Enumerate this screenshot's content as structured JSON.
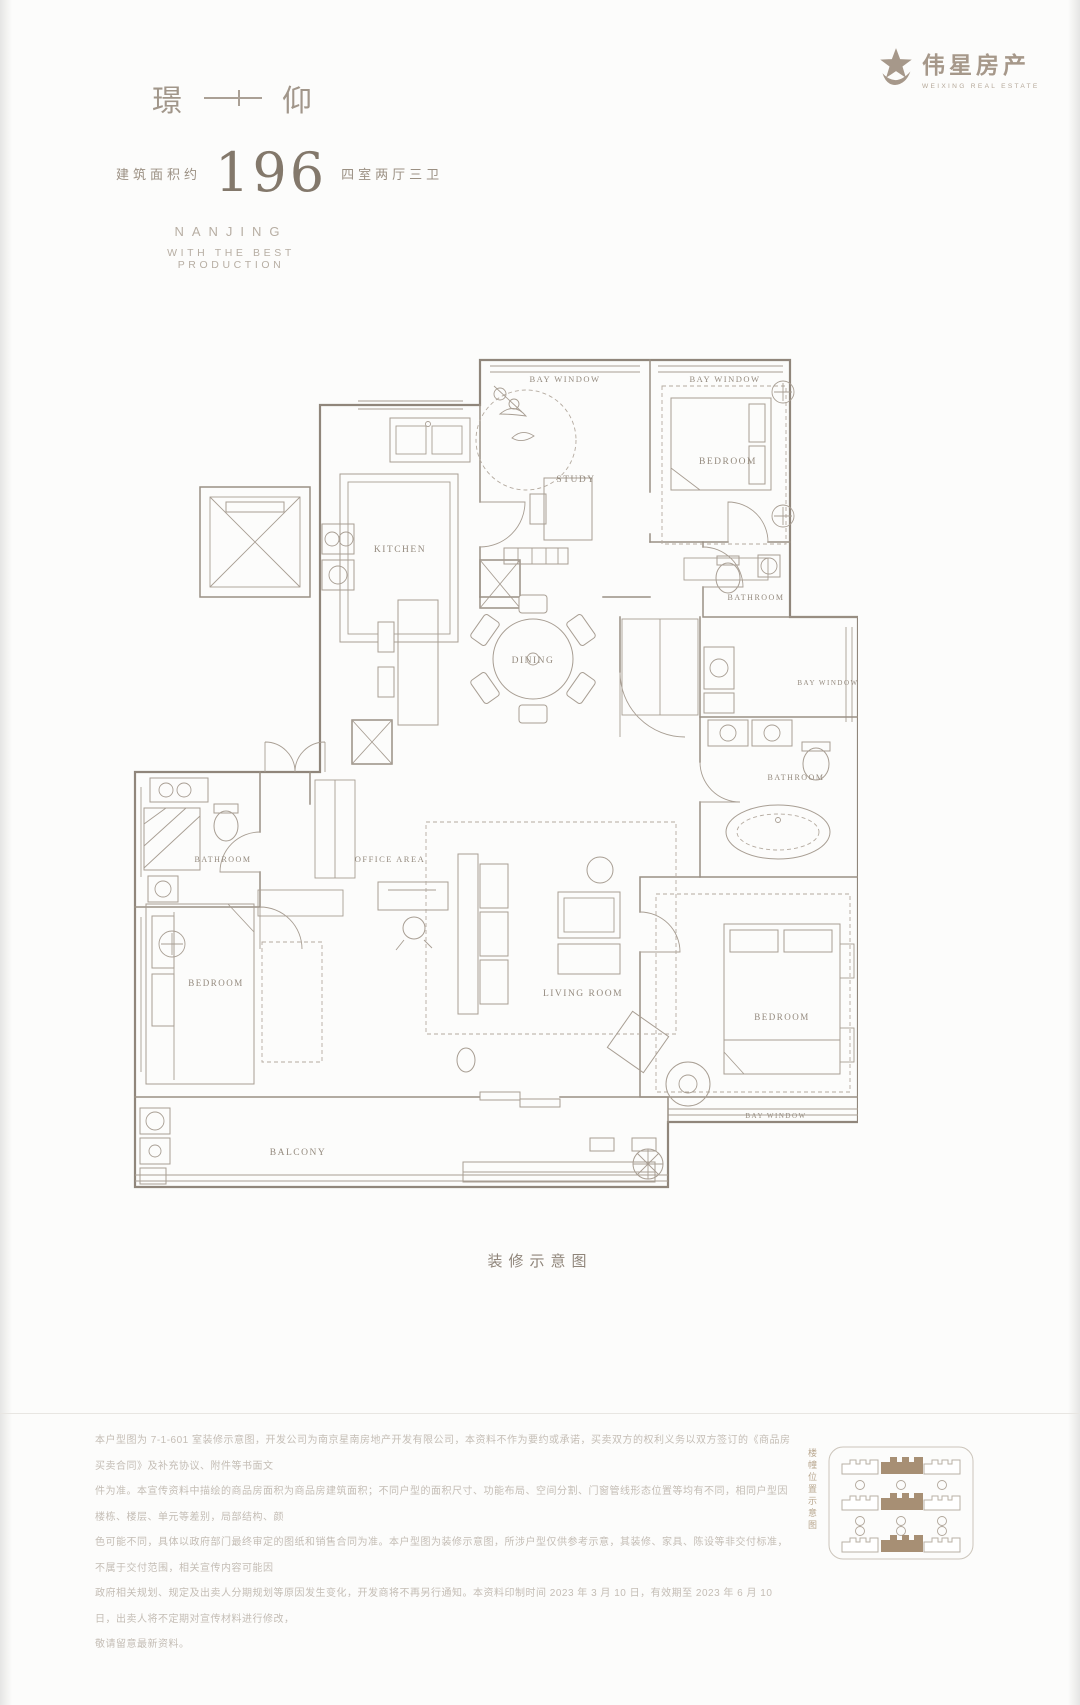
{
  "brand": {
    "logo_cn": "伟星房产",
    "logo_en": "WEIXING REAL ESTATE"
  },
  "header": {
    "title_left": "璟",
    "title_right": "仰",
    "area_label": "建筑面积约",
    "area_value": "196",
    "layout_label": "四室两厅三卫",
    "subtitle_line1": "NANJING",
    "subtitle_line2": "WITH THE BEST PRODUCTION"
  },
  "plan": {
    "caption": "装修示意图",
    "rooms": [
      {
        "label": "BAY WINDOW",
        "x": 437,
        "y": 30,
        "s": 8.5
      },
      {
        "label": "BAY WINDOW",
        "x": 597,
        "y": 30,
        "s": 8.5
      },
      {
        "label": "KITCHEN",
        "x": 272,
        "y": 200,
        "s": 9.5
      },
      {
        "label": "STUDY",
        "x": 448,
        "y": 130,
        "s": 9.5
      },
      {
        "label": "BEDROOM",
        "x": 600,
        "y": 112,
        "s": 9.5
      },
      {
        "label": "BATHROOM",
        "x": 628,
        "y": 248,
        "s": 8
      },
      {
        "label": "BAY WINDOW",
        "x": 700,
        "y": 333,
        "s": 7
      },
      {
        "label": "DINING",
        "x": 405,
        "y": 311,
        "s": 9.5
      },
      {
        "label": "BATHROOM",
        "x": 668,
        "y": 428,
        "s": 8
      },
      {
        "label": "OFFICE AREA",
        "x": 262,
        "y": 510,
        "s": 8.5
      },
      {
        "label": "BATHROOM",
        "x": 95,
        "y": 510,
        "s": 8
      },
      {
        "label": "LIVING ROOM",
        "x": 455,
        "y": 644,
        "s": 9.5
      },
      {
        "label": "BEDROOM",
        "x": 88,
        "y": 634,
        "s": 9
      },
      {
        "label": "BEDROOM",
        "x": 654,
        "y": 668,
        "s": 9
      },
      {
        "label": "BALCONY",
        "x": 170,
        "y": 803,
        "s": 9.5
      },
      {
        "label": "BAY WINDOW",
        "x": 648,
        "y": 766,
        "s": 7
      }
    ]
  },
  "footer": {
    "disclaimer_lines": [
      "本户型图为 7-1-601 室装修示意图，开发公司为南京星南房地产开发有限公司，本资料不作为要约或承诺，买卖双方的权利义务以双方签订的《商品房买卖合同》及补充协议、附件等书面文",
      "件为准。本宣传资料中描绘的商品房面积为商品房建筑面积；不同户型的面积尺寸、功能布局、空间分割、门窗管线形态位置等均有不同，相同户型因楼栋、楼层、单元等差别，局部结构、颜",
      "色可能不同，具体以政府部门最终审定的图纸和销售合同为准。本户型图为装修示意图，所涉户型仅供参考示意，其装修、家具、陈设等非交付标准，不属于交付范围，相关宣传内容可能因",
      "政府相关规划、规定及出卖人分期规划等原因发生变化，开发商将不再另行通知。本资料印制时间 2023 年 3 月 10 日，有效期至 2023 年 6 月 10 日，出卖人将不定期对宣传材料进行修改，",
      "敬请留意最新资料。"
    ],
    "keyplan_caption": "楼幢位置示意图"
  },
  "colors": {
    "wall_line": "#90867b",
    "label_text": "#948a7e",
    "brand": "#a6988a",
    "keyplan_highlight": "#a78f74"
  }
}
